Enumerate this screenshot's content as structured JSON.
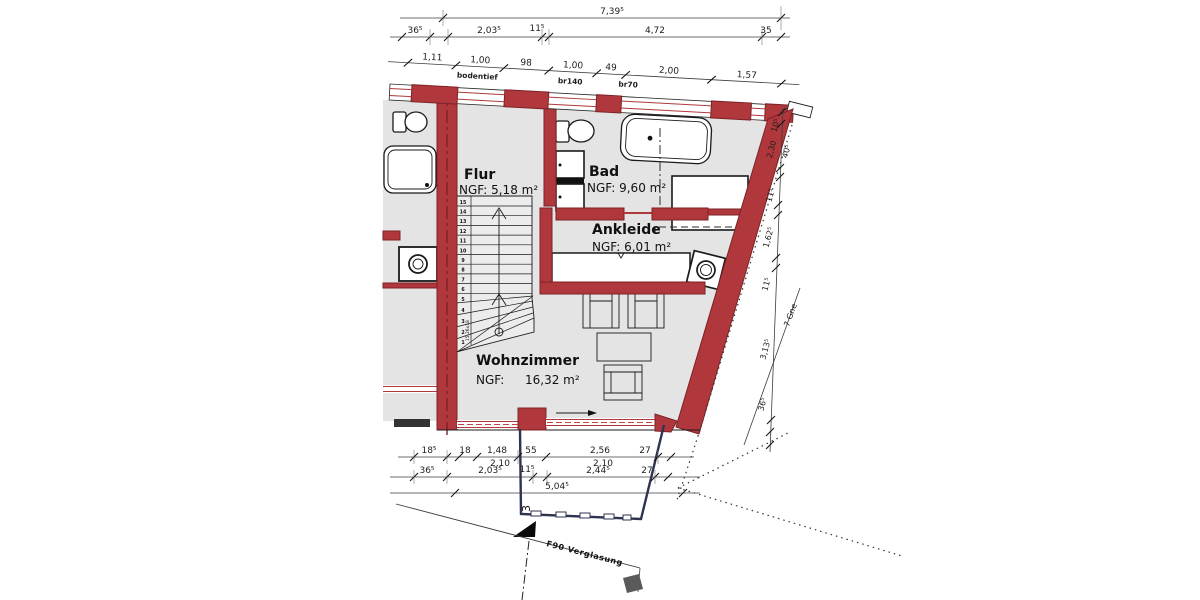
{
  "drawing_type": "floor-plan",
  "rooms": {
    "flur": {
      "name": "Flur",
      "ngf": "NGF: 5,18 m²"
    },
    "bad": {
      "name": "Bad",
      "ngf": "NGF: 9,60 m²"
    },
    "ankleide": {
      "name": "Ankleide",
      "ngf": "NGF: 6,01 m²"
    },
    "wohnzimmer": {
      "name": "Wohnzimmer",
      "ngf_label": "NGF:",
      "ngf_value": "16,32 m²"
    }
  },
  "dims": {
    "top_total": "7,39⁵",
    "top_row": [
      "36⁵",
      "2,03⁵",
      "11⁵",
      "4,72",
      "35"
    ],
    "wall_row": [
      "1,11",
      "1,00",
      "98",
      "1,00",
      "49",
      "2,00",
      "1,57"
    ],
    "wall_labels": [
      "bodentief",
      "br140",
      "br70"
    ],
    "right_chain": [
      "10⁵",
      "40⁵",
      "2,30",
      "11⁵",
      "1,62⁵",
      "11⁵",
      "3,13⁵",
      "36⁵"
    ],
    "right_leader": "7 Gne",
    "bottom_row1": [
      "18⁵",
      "18",
      "1,48",
      "55",
      "2,56",
      "27"
    ],
    "bottom_row1_sub": [
      "2,10",
      "2,10"
    ],
    "bottom_row2": [
      "36⁵",
      "2,03⁵",
      "11⁵",
      "2,44⁵",
      "27"
    ],
    "bottom_total": "5,04⁵"
  },
  "stair": {
    "numbers": [
      "1",
      "2",
      "3",
      "4",
      "5",
      "6",
      "7",
      "8",
      "9",
      "10",
      "11",
      "12",
      "13",
      "14",
      "15"
    ],
    "label": "15,26x18"
  },
  "annotations": {
    "glazing": "F90 Verglasung",
    "balcony_mark": "3"
  },
  "colors": {
    "wall": "#b0383c",
    "wall_outline": "#7c2226",
    "floor": "#e4e4e4",
    "window_dash": "#c4414a",
    "balcony_line": "#2e3350"
  }
}
